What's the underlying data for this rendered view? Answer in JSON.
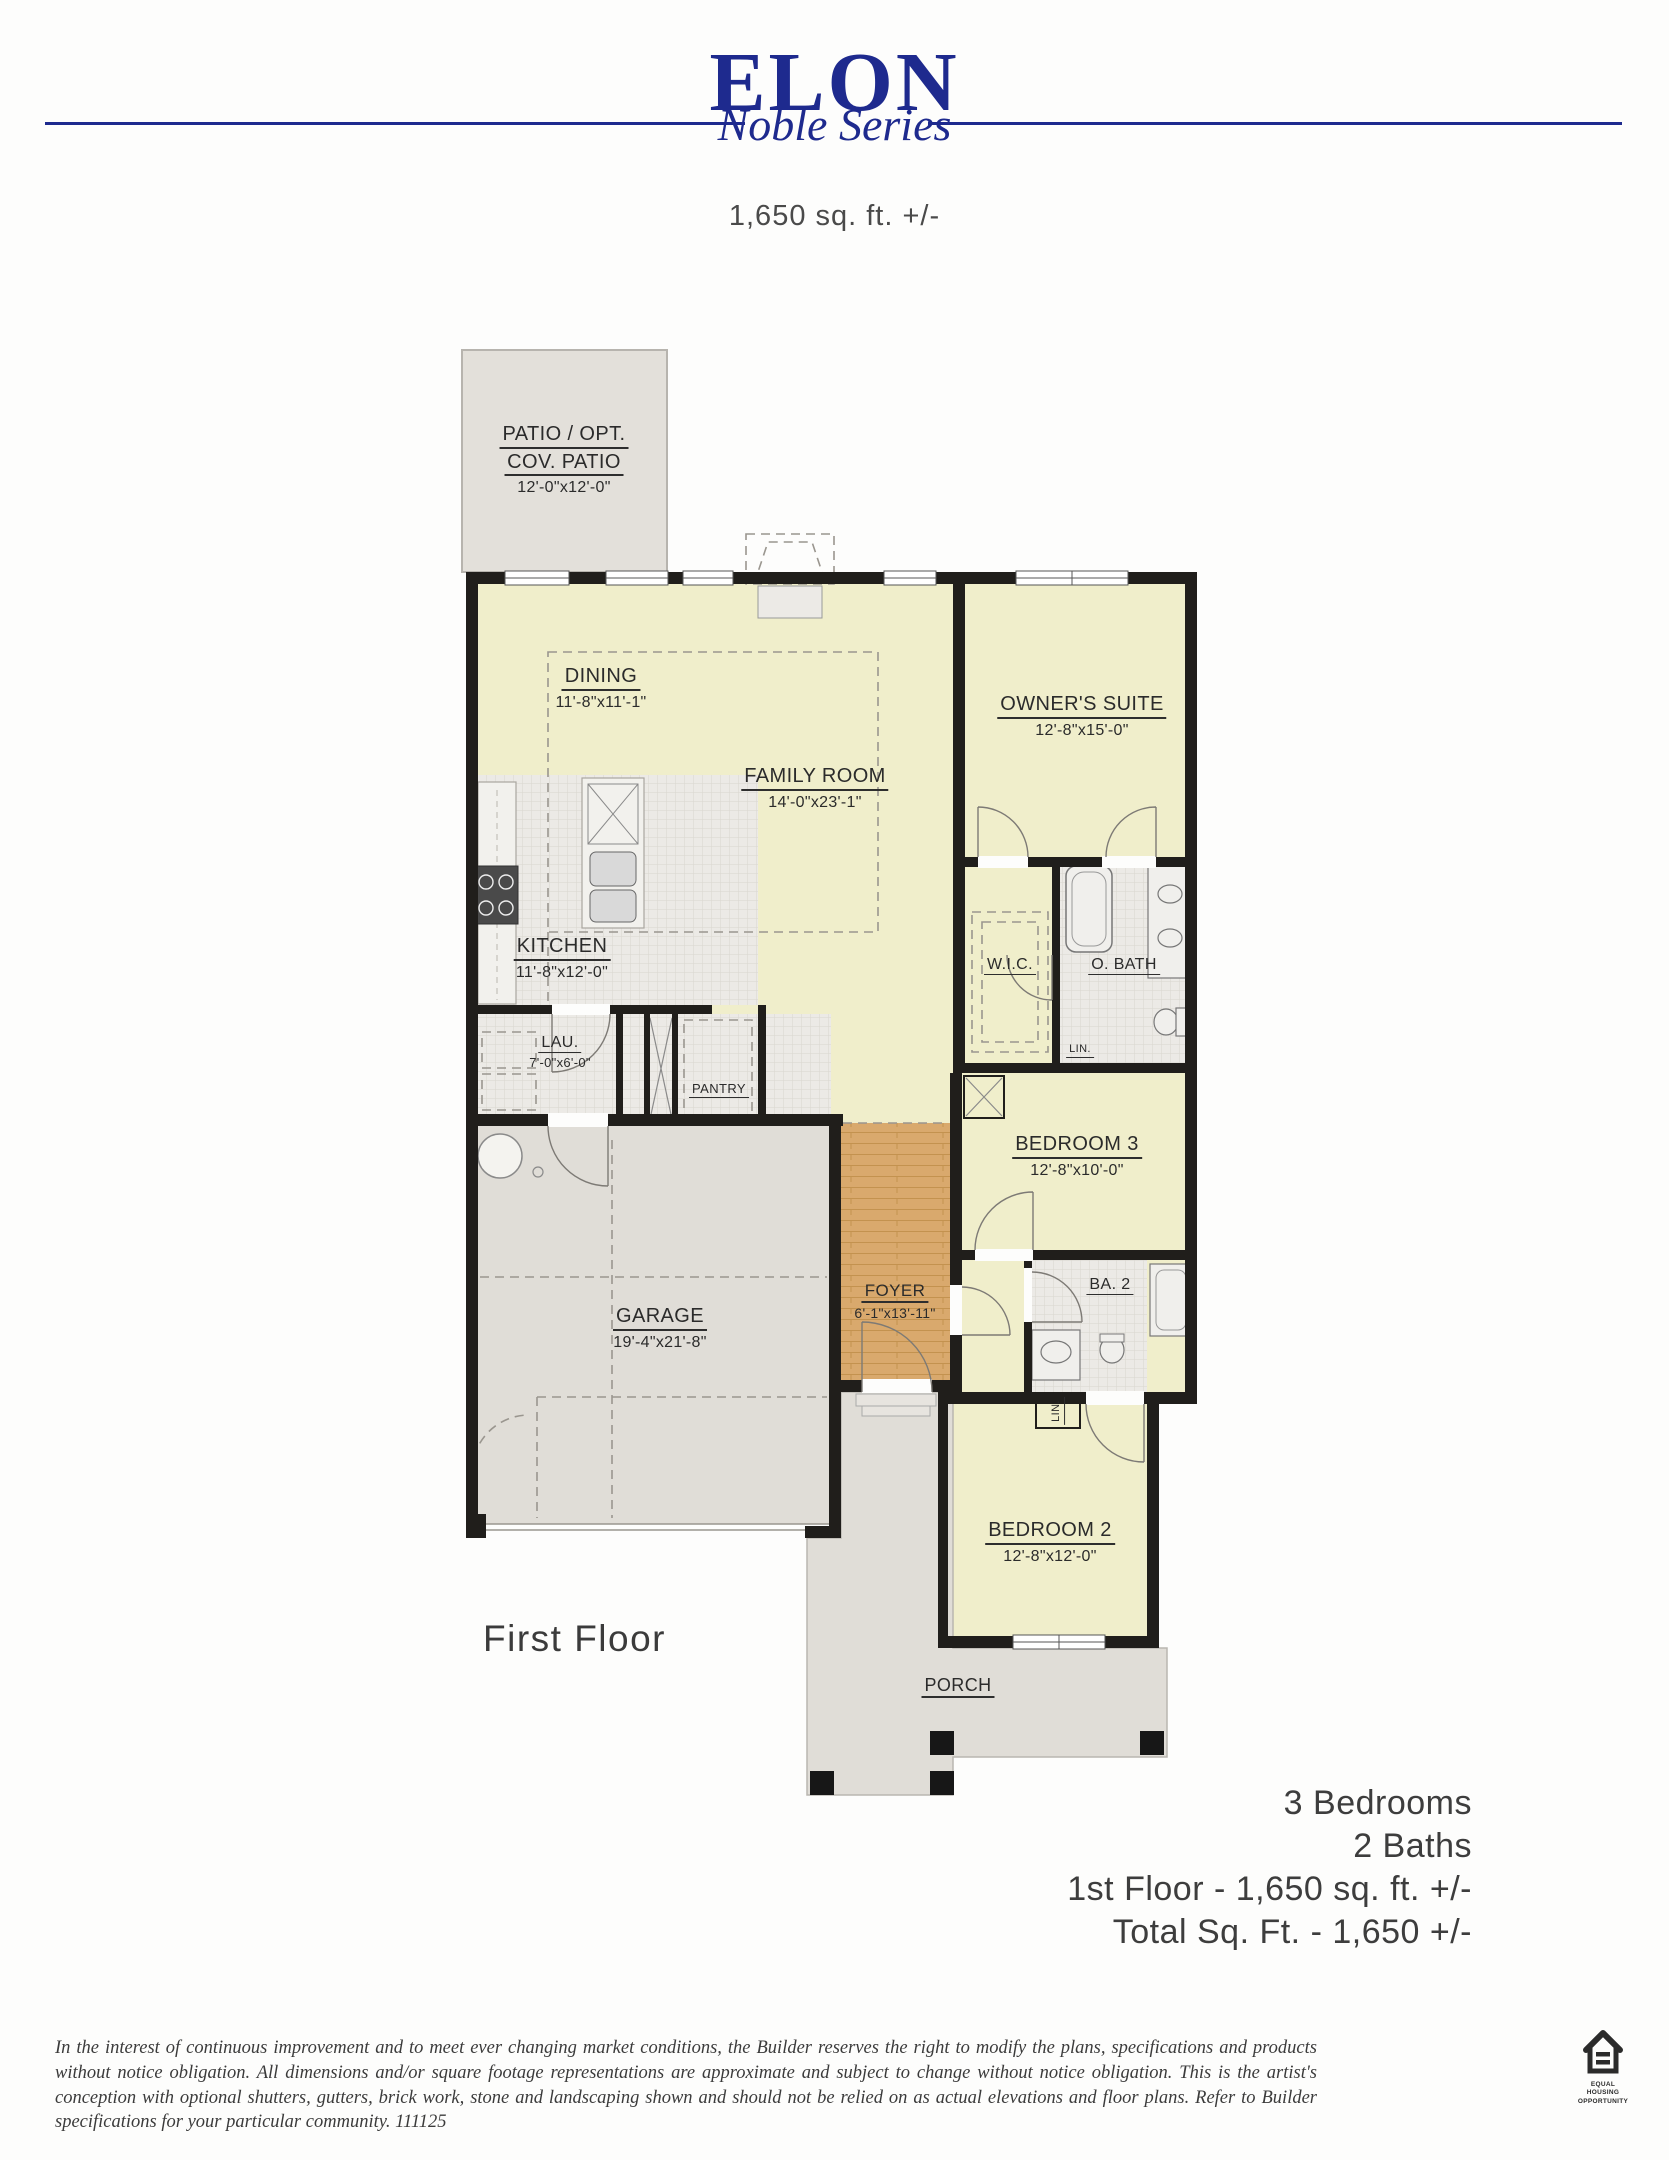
{
  "header": {
    "title": "ELON",
    "series": "Noble Series",
    "sqft": "1,650 sq. ft. +/-"
  },
  "plan": {
    "floor_label": "First Floor",
    "rooms": {
      "patio": {
        "line1": "PATIO / OPT.",
        "line2": "COV. PATIO",
        "dims": "12'-0\"x12'-0\""
      },
      "dining": {
        "name": "DINING",
        "dims": "11'-8\"x11'-1\""
      },
      "family": {
        "name": "FAMILY ROOM",
        "dims": "14'-0\"x23'-1\""
      },
      "owners": {
        "name": "OWNER'S SUITE",
        "dims": "12'-8\"x15'-0\""
      },
      "kitchen": {
        "name": "KITCHEN",
        "dims": "11'-8\"x12'-0\""
      },
      "laundry": {
        "name": "LAU.",
        "dims": "7'-0\"x6'-0\""
      },
      "pantry": {
        "name": "PANTRY"
      },
      "wic": {
        "name": "W.I.C."
      },
      "obath": {
        "name": "O. BATH"
      },
      "linen1": {
        "name": "LIN."
      },
      "bedroom3": {
        "name": "BEDROOM 3",
        "dims": "12'-8\"x10'-0\""
      },
      "bath2": {
        "name": "BA. 2"
      },
      "linen2": {
        "name": "LIN."
      },
      "foyer": {
        "name": "FOYER",
        "dims": "6'-1\"x13'-11\""
      },
      "garage": {
        "name": "GARAGE",
        "dims": "19'-4\"x21'-8\""
      },
      "bedroom2": {
        "name": "BEDROOM 2",
        "dims": "12'-8\"x12'-0\""
      },
      "porch": {
        "name": "PORCH"
      }
    }
  },
  "summary": {
    "bedrooms": "3 Bedrooms",
    "baths": "2 Baths",
    "first_floor": "1st Floor - 1,650 sq. ft. +/-",
    "total": "Total Sq. Ft. - 1,650 +/-"
  },
  "disclaimer": "In the interest of continuous improvement and to meet ever changing market conditions, the Builder reserves the right to modify the plans,  specifications and products without notice obligation. All dimensions and/or square footage representations are approximate and subject to change without notice obligation. This is the artist's conception with optional shutters, gutters, brick work, stone and landscaping shown and should not be relied on as actual elevations and floor plans. Refer to Builder specifications for your particular community. 111125",
  "eho": {
    "line1": "EQUAL HOUSING",
    "line2": "OPPORTUNITY"
  },
  "colors": {
    "navy": "#1e2a8e",
    "room_yellow": "#f0eecb",
    "floor_grey": "#e0ddd7",
    "patio_grey": "#e3e0da",
    "wood": "#d9a96d",
    "tile": "#eceae6",
    "wall": "#201e1b",
    "text_grey": "#3d3d3d"
  }
}
